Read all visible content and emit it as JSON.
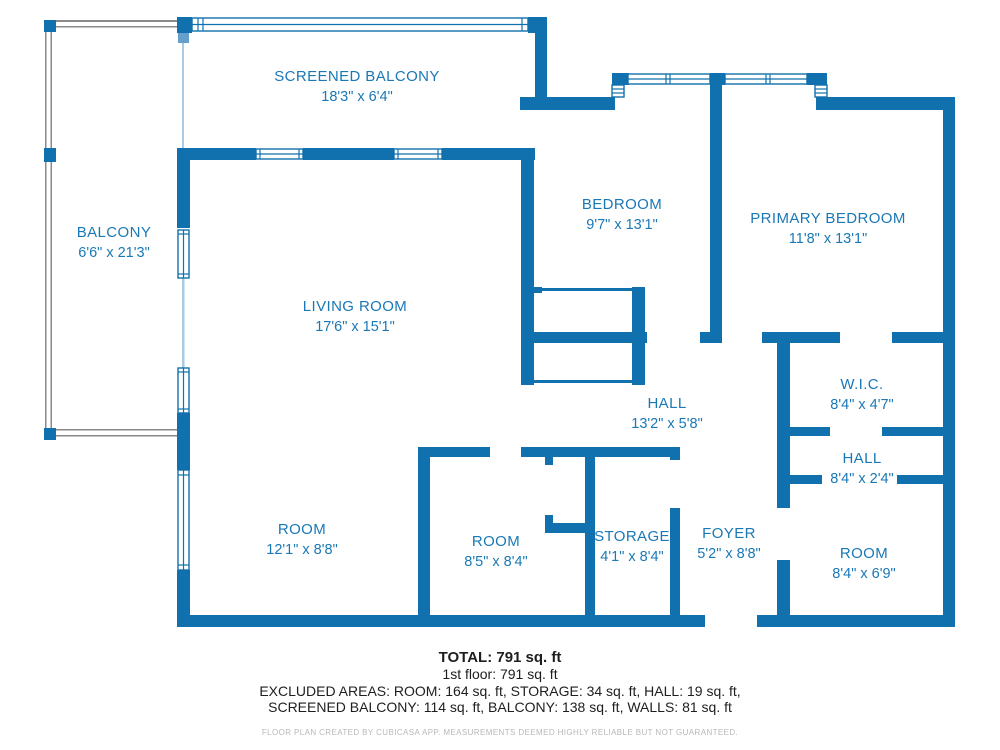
{
  "title": "Floor plan",
  "colors": {
    "wall_blue": "#1171ae",
    "room_text_blue": "#1a78b6",
    "railing_gray": "#8a8a8a",
    "summary_text": "#1e1e1e",
    "disclaimer_gray": "#b8b8b8"
  },
  "rooms": [
    {
      "id": "screened-balcony",
      "name": "SCREENED BALCONY",
      "dims": "18'3\" x 6'4\""
    },
    {
      "id": "balcony",
      "name": "BALCONY",
      "dims": "6'6\" x 21'3\""
    },
    {
      "id": "living-room",
      "name": "LIVING ROOM",
      "dims": "17'6\" x 15'1\""
    },
    {
      "id": "bedroom",
      "name": "BEDROOM",
      "dims": "9'7\" x 13'1\""
    },
    {
      "id": "primary-bedroom",
      "name": "PRIMARY BEDROOM",
      "dims": "11'8\" x 13'1\""
    },
    {
      "id": "wic",
      "name": "W.I.C.",
      "dims": "8'4\" x 4'7\""
    },
    {
      "id": "hall-1",
      "name": "HALL",
      "dims": "13'2\" x 5'8\""
    },
    {
      "id": "hall-2",
      "name": "HALL",
      "dims": "8'4\" x 2'4\""
    },
    {
      "id": "room-1",
      "name": "ROOM",
      "dims": "12'1\" x 8'8\""
    },
    {
      "id": "room-2",
      "name": "ROOM",
      "dims": "8'5\" x 8'4\""
    },
    {
      "id": "storage",
      "name": "STORAGE",
      "dims": "4'1\" x 8'4\""
    },
    {
      "id": "foyer",
      "name": "FOYER",
      "dims": "5'2\" x 8'8\""
    },
    {
      "id": "room-3",
      "name": "ROOM",
      "dims": "8'4\" x 6'9\""
    }
  ],
  "summary": {
    "total": "TOTAL: 791 sq. ft",
    "floor": "1st floor: 791 sq. ft",
    "excluded_line1": "EXCLUDED AREAS: ROOM: 164 sq. ft, STORAGE: 34 sq. ft, HALL: 19 sq. ft,",
    "excluded_line2": "SCREENED BALCONY: 114 sq. ft, BALCONY: 138 sq. ft, WALLS: 81 sq. ft",
    "disclaimer": "FLOOR PLAN CREATED BY CUBICASA APP. MEASUREMENTS DEEMED HIGHLY RELIABLE BUT NOT GUARANTEED."
  }
}
